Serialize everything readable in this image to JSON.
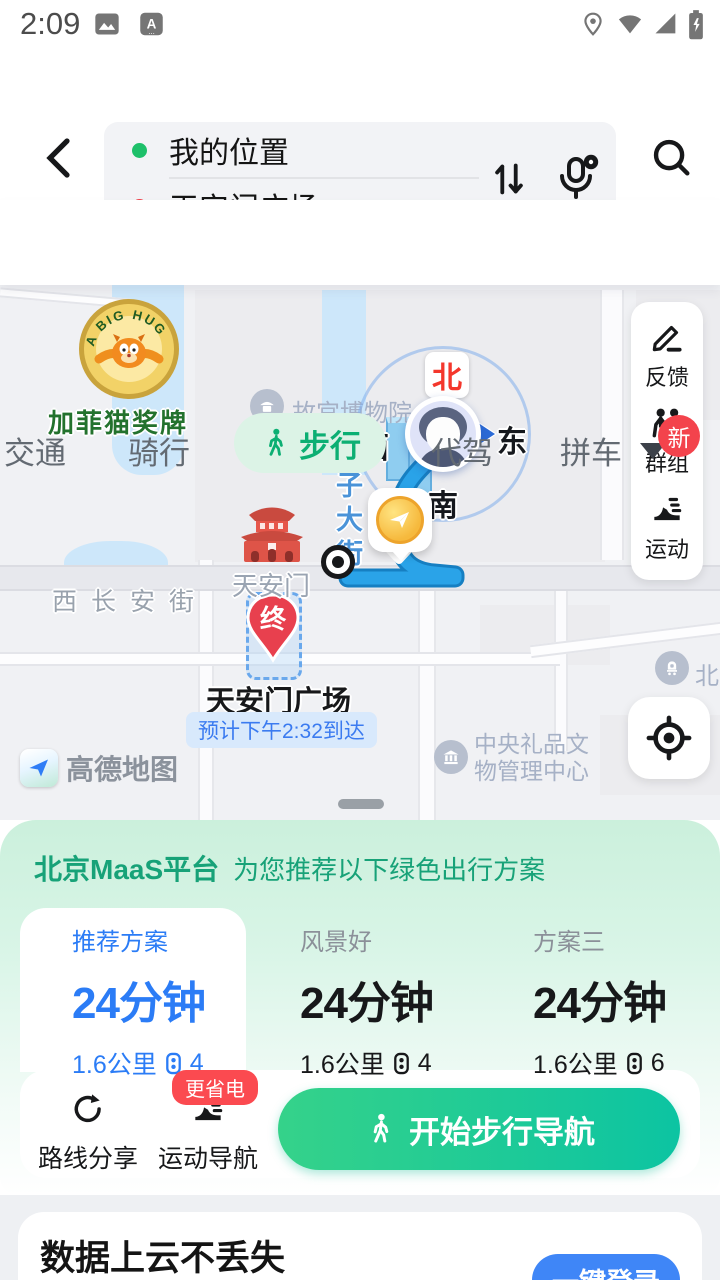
{
  "status_bar": {
    "time": "2:09"
  },
  "header": {
    "origin": "我的位置",
    "destination": "天安门广场",
    "waypoint_label": "途经点"
  },
  "tabs": {
    "items": [
      "交通",
      "骑行",
      "步行",
      "代驾",
      "拼车"
    ],
    "new_badge": "新"
  },
  "map": {
    "medal_arc_text": "A BIG HUG",
    "medal_label": "加菲猫奖牌",
    "poi_palace": "故宫博物院",
    "poi_tiananmen": "天安门",
    "poi_square": "天安门广场",
    "eta": "预计下午2:32到达",
    "road_changan": "西长安街",
    "street_vertical": "池子大街",
    "poi_gift_center_line1": "中央礼品文",
    "poi_gift_center_line2": "物管理中心",
    "poi_station": "北京",
    "compass": {
      "north": "北",
      "east": "东",
      "south": "南",
      "west": "西"
    },
    "end_pin": "终",
    "attribution": "高德地图",
    "side_panel": [
      {
        "label": "反馈"
      },
      {
        "label": "群组"
      },
      {
        "label": "运动"
      }
    ]
  },
  "sheet": {
    "maas_title": "北京MaaS平台",
    "maas_subtitle": "为您推荐以下绿色出行方案",
    "plans": [
      {
        "name": "推荐方案",
        "time": "24分钟",
        "distance": "1.6公里",
        "lights": "4"
      },
      {
        "name": "风景好",
        "time": "24分钟",
        "distance": "1.6公里",
        "lights": "4"
      },
      {
        "name": "方案三",
        "time": "24分钟",
        "distance": "1.6公里",
        "lights": "6"
      }
    ],
    "share_label": "路线分享",
    "sport_label": "运动导航",
    "sport_badge": "更省电",
    "start_button": "开始步行导航"
  },
  "footer": {
    "title": "数据上云不丢失",
    "login_button": "一键登录"
  },
  "colors": {
    "accent_green": "#0caf73",
    "accent_blue": "#2b7cf6",
    "badge_red": "#f3434c",
    "route_blue": "#2aa3e8",
    "pin_red": "#e8404e"
  }
}
